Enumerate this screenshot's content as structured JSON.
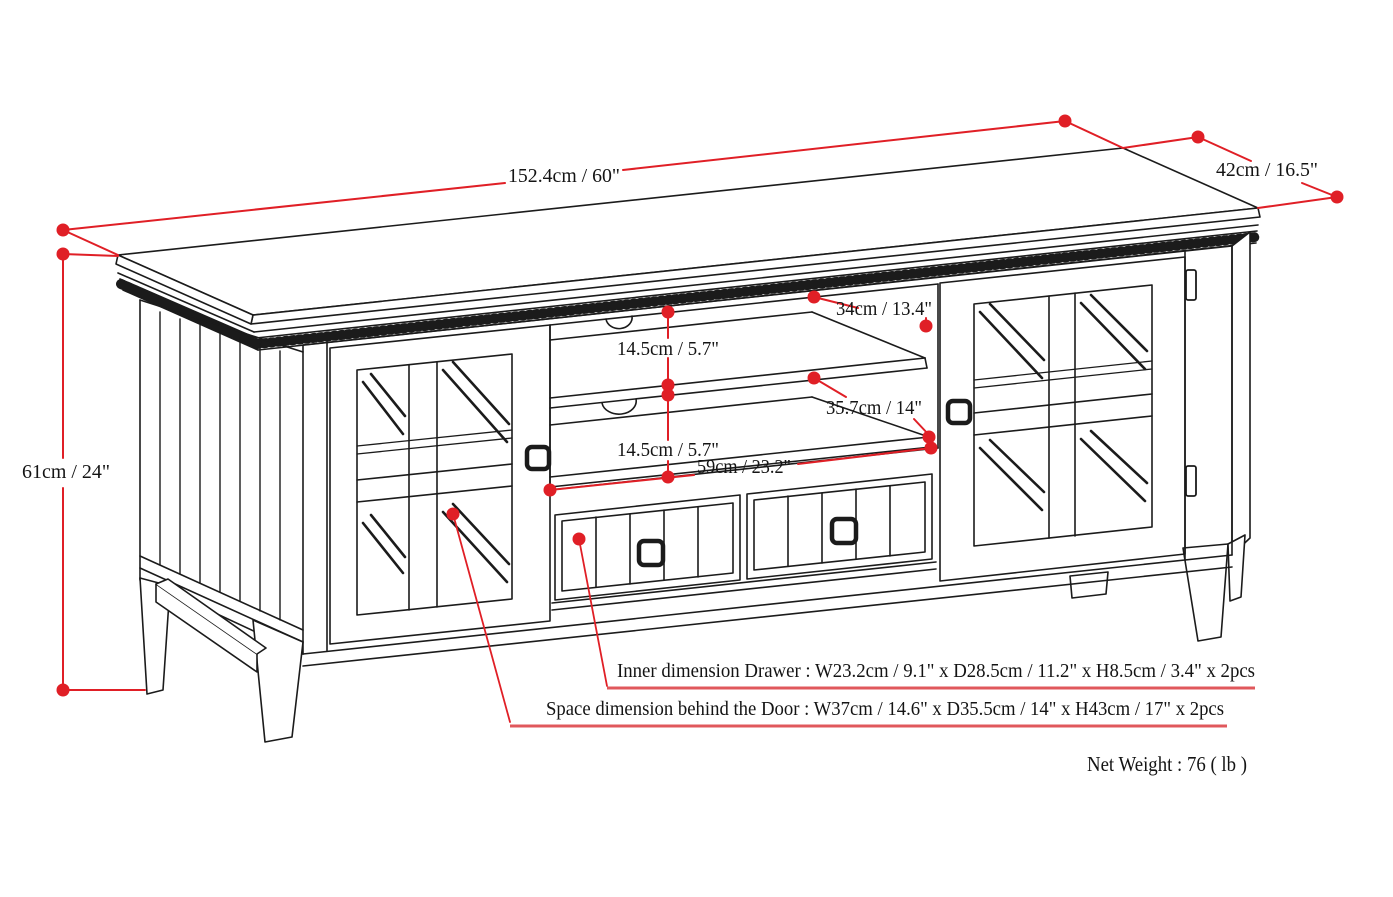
{
  "diagram": {
    "type": "furniture-dimension-drawing",
    "product": "TV stand with two glass doors, two drawers and open center shelves",
    "colors": {
      "line": "#1b1b1b",
      "dimension_red": "#e01f26",
      "underline_red": "#e0585c",
      "background": "#ffffff"
    },
    "dimensions": {
      "overall_width": "152.4cm / 60\"",
      "overall_depth": "42cm / 16.5\"",
      "overall_height": "61cm / 24\"",
      "top_shelf_depth": "34cm / 13.4\"",
      "upper_shelf_gap": "14.5cm / 5.7\"",
      "middle_shelf_depth": "35.7cm / 14\"",
      "lower_shelf_gap": "14.5cm / 5.7\"",
      "center_opening_width": "59cm / 23.2\""
    },
    "notes": {
      "drawer": "Inner dimension Drawer : W23.2cm / 9.1\" x D28.5cm / 11.2\" x H8.5cm / 3.4\" x 2pcs",
      "door": "Space dimension behind the Door  : W37cm / 14.6\" x D35.5cm / 14\" x H43cm / 17\" x 2pcs",
      "net_weight": "Net Weight : 76 ( lb )"
    }
  }
}
